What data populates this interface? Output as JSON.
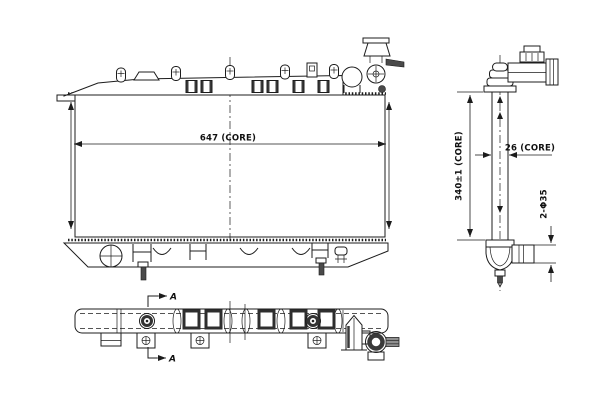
{
  "colors": {
    "background": "#ffffff",
    "line": "#1c1c1c",
    "dark_fill": "#4a4a4a"
  },
  "dimensions": {
    "core_width": "647 (CORE)",
    "core_height": "340±1 (CORE)",
    "core_depth": "26 (CORE)",
    "pipe_diameter": "2-Φ35"
  },
  "section_markers": {
    "label": "A"
  }
}
